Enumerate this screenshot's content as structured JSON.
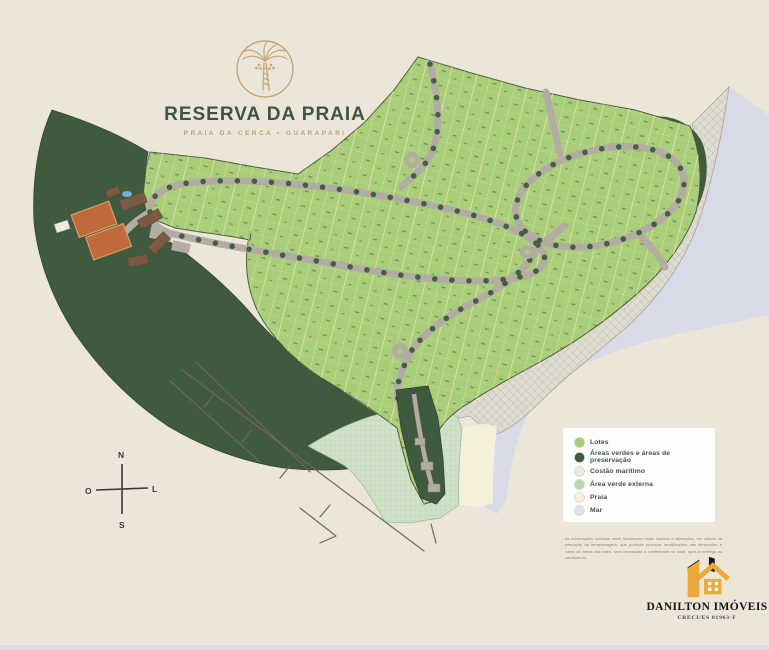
{
  "branding": {
    "title": "RESERVA DA PRAIA",
    "subtitle": "PRAIA DA CERCA • GUARAPARI"
  },
  "compass": {
    "north": "N",
    "south": "S",
    "west": "O",
    "east": "L"
  },
  "legend": {
    "items": [
      {
        "label": "Lotes",
        "color": "#a5cc76"
      },
      {
        "label": "Áreas verdes e áreas de preservação",
        "color": "#3f5a3e"
      },
      {
        "label": "Costão marítimo",
        "color": "#eceae1"
      },
      {
        "label": "Área verde externa",
        "color": "#b9d8ae"
      },
      {
        "label": "Praia",
        "color": "#f6f1e1"
      },
      {
        "label": "Mar",
        "color": "#dfe2ec"
      }
    ]
  },
  "disclaimer": "As informações contidas neste Masterplan estão sujeitas a alterações, em virtude da execução da terraplenagem, que poderão provocar modificações nas dimensões e cotas de áreas dos lotes, será necessária a conferência no local, após a entrega do condomínio.",
  "footer_brand": {
    "name": "DANILTON IMÓVEIS",
    "registration": "CRECI/ES 01963-F"
  },
  "map": {
    "colors": {
      "background": "#ece6d9",
      "lots": "#a9ce79",
      "preservation": "#3f5a3e",
      "road": "#b3aca3",
      "sea": "#d9dae7",
      "coast": "#dfdcd2",
      "beach": "#f5f0da",
      "green_external": "#cfe2c9",
      "court": "#bf6a3c",
      "building": "#7a5a42",
      "pool": "#6fb3d6",
      "bottom_bar": "#dcdde4"
    }
  }
}
